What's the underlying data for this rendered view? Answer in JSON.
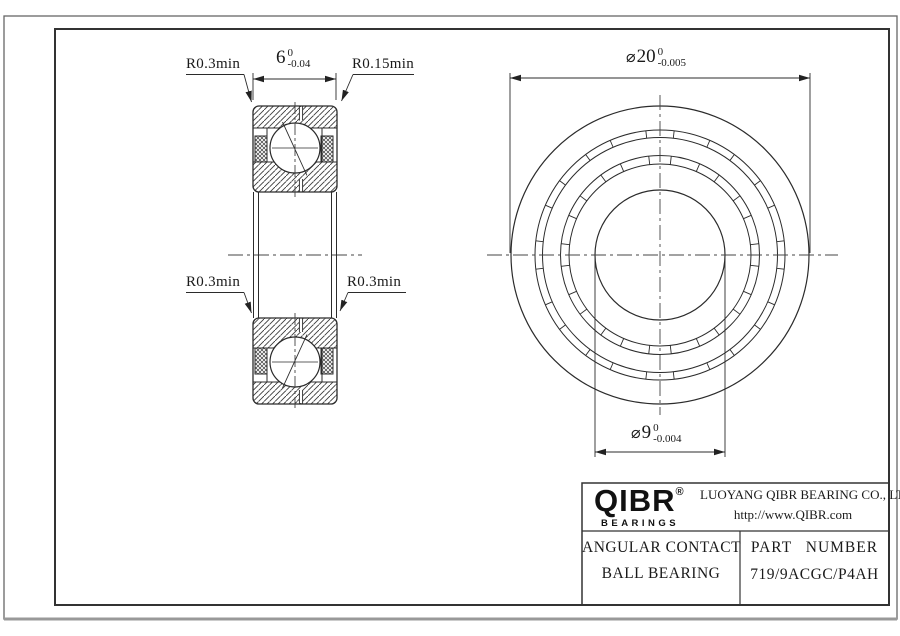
{
  "labels": {
    "r_top_left": "R0.3min",
    "r_top_right": "R0.15min",
    "r_bottom_left": "R0.3min",
    "r_bottom_right": "R0.3min"
  },
  "dimensions": {
    "width": {
      "symbol": "",
      "value": "6",
      "upper": "0",
      "lower": "-0.04"
    },
    "outer_diameter": {
      "symbol": "⌀",
      "value": "20",
      "upper": "0",
      "lower": "-0.005"
    },
    "bore_diameter": {
      "symbol": "⌀",
      "value": "9",
      "upper": "0",
      "lower": "-0.004"
    }
  },
  "title_block": {
    "logo_name": "QIBR",
    "logo_registered": "®",
    "logo_tagline": "BEARINGS",
    "company": "LUOYANG QIBR BEARING CO., LTD",
    "website": "http://www.QIBR.com",
    "product_line1": "ANGULAR CONTACT",
    "product_line2": "BALL BEARING",
    "part_number_label": "PART NUMBER",
    "part_number": "719/9ACGC/P4AH"
  },
  "colors": {
    "line": "#2b2b2b",
    "background": "#ffffff"
  }
}
